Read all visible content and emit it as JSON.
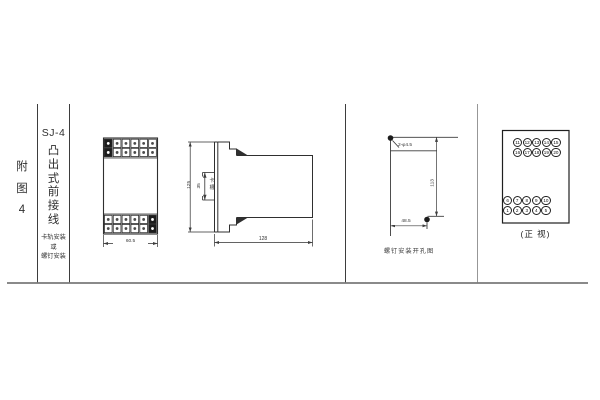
{
  "page": {
    "bg": "#ffffff",
    "line_color": "#3d3d3d"
  },
  "sidebar": {
    "figure_label_chars": [
      "附",
      "图",
      "4"
    ],
    "model": "SJ-4",
    "product_chars": [
      "凸",
      "出",
      "式",
      "前",
      "接",
      "线"
    ],
    "mounting_note_lines": [
      "卡轨安装",
      "或",
      "螺钉安装"
    ]
  },
  "front_view": {
    "width_dim": "60.5",
    "terminal_grid": {
      "cols": 6,
      "rows": 2,
      "filled_top_col": 1,
      "filled_bottom_col": 6
    }
  },
  "side_view": {
    "height_dim": "125",
    "slot_dim": "35",
    "slot_label_chars": [
      "卡",
      "槽"
    ],
    "depth_dim": "128"
  },
  "drill_view": {
    "holes_label": "2-φ4.5",
    "vertical_dim": "113",
    "horizontal_dim": "48.5",
    "caption": "螺钉安装开孔图"
  },
  "rear_view": {
    "caption": "(正 视)",
    "top_rows": [
      [
        "11",
        "12",
        "13",
        "14",
        "15"
      ],
      [
        "16",
        "17",
        "18",
        "19",
        "20"
      ]
    ],
    "bottom_rows": [
      [
        "6",
        "7",
        "8",
        "9",
        "10"
      ],
      [
        "1",
        "2",
        "3",
        "4",
        "5"
      ]
    ]
  }
}
